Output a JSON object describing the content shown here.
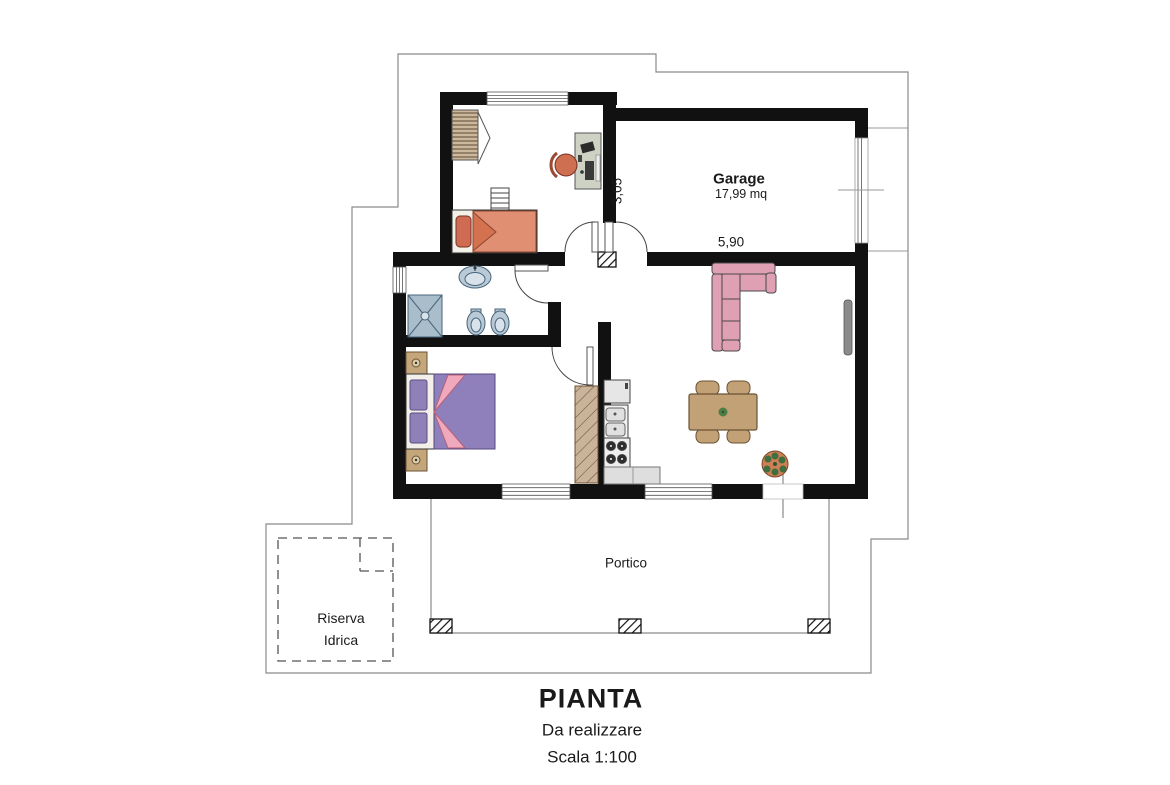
{
  "labels": {
    "garage_name": "Garage",
    "garage_area": "17,99 mq",
    "garage_width": "5,90",
    "garage_depth": "3,05",
    "portico": "Portico",
    "riserva_line1": "Riserva",
    "riserva_line2": "Idrica"
  },
  "title_block": {
    "title": "PIANTA",
    "subtitle": "Da realizzare",
    "scale": "Scala 1:100"
  },
  "colors": {
    "wall": "#111111",
    "boundary_line": "#8a8a8a",
    "sofa_pink": "#dfa0b4",
    "bed_blanket_orange": "#e08f72",
    "pillow_red": "#cf6b52",
    "duvet_purple": "#8f7fba",
    "fold_pink": "#f0a9bc",
    "wood_tan": "#c2a176",
    "sanitary_blue": "#b9c9d6",
    "desk_gray": "#cdd2c4",
    "chair_terracotta": "#cd6f50",
    "plant_green": "#3f6f3f",
    "pot_orange": "#cf7f55"
  }
}
